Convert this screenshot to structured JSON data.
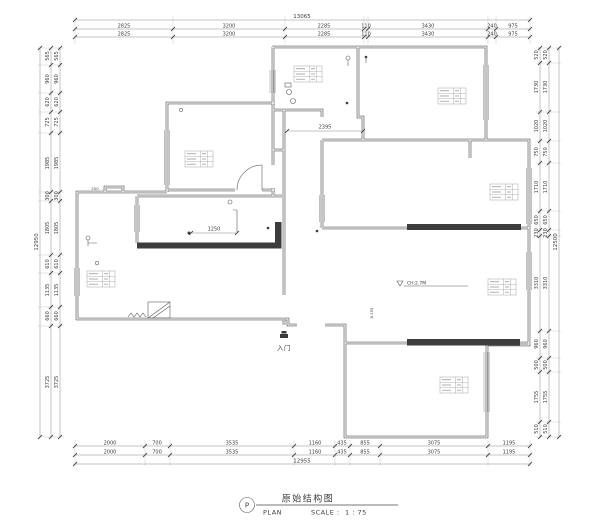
{
  "title_block": {
    "marker": "P",
    "title": "原始结构图",
    "plan_label": "PLAN",
    "scale_label": "SCALE :",
    "scale_value": "1 : 75"
  },
  "interior": {
    "corridor_dim": "2395",
    "opening_dim": "1250",
    "ceiling_note": "CH:2.7M",
    "vertical_note": "8.155",
    "step_note": "250",
    "entry_label": "入门"
  },
  "dims": {
    "top": {
      "overall": "13065",
      "rows": [
        [
          "2825",
          "3200",
          "2285",
          "110",
          "3430",
          "240",
          "975"
        ],
        [
          "2825",
          "3200",
          "2285",
          "110",
          "3430",
          "240",
          "975"
        ]
      ]
    },
    "bottom": {
      "overall": "12955",
      "rows": [
        [
          "2000",
          "700",
          "3535",
          "1160",
          "435",
          "855",
          "3075",
          "1195"
        ],
        [
          "2000",
          "700",
          "3535",
          "1160",
          "435",
          "855",
          "3075",
          "1195"
        ]
      ]
    },
    "left": {
      "overall": "12950",
      "rows": [
        [
          "565",
          "960",
          "620",
          "725",
          "1985",
          "300",
          "1805",
          "610",
          "1135",
          "660",
          "3725"
        ],
        [
          "565",
          "960",
          "620",
          "725",
          "1985",
          "300",
          "1805",
          "610",
          "1135",
          "660",
          "3725"
        ]
      ]
    },
    "right": {
      "overall": "12500",
      "rows": [
        [
          "520",
          "1730",
          "1020",
          "750",
          "1710",
          "650",
          "230",
          "3310",
          "960",
          "500",
          "1755",
          "510"
        ],
        [
          "520",
          "1730",
          "1020",
          "750",
          "1710",
          "650",
          "230",
          "3310",
          "960",
          "500",
          "1755",
          "510"
        ]
      ]
    }
  }
}
